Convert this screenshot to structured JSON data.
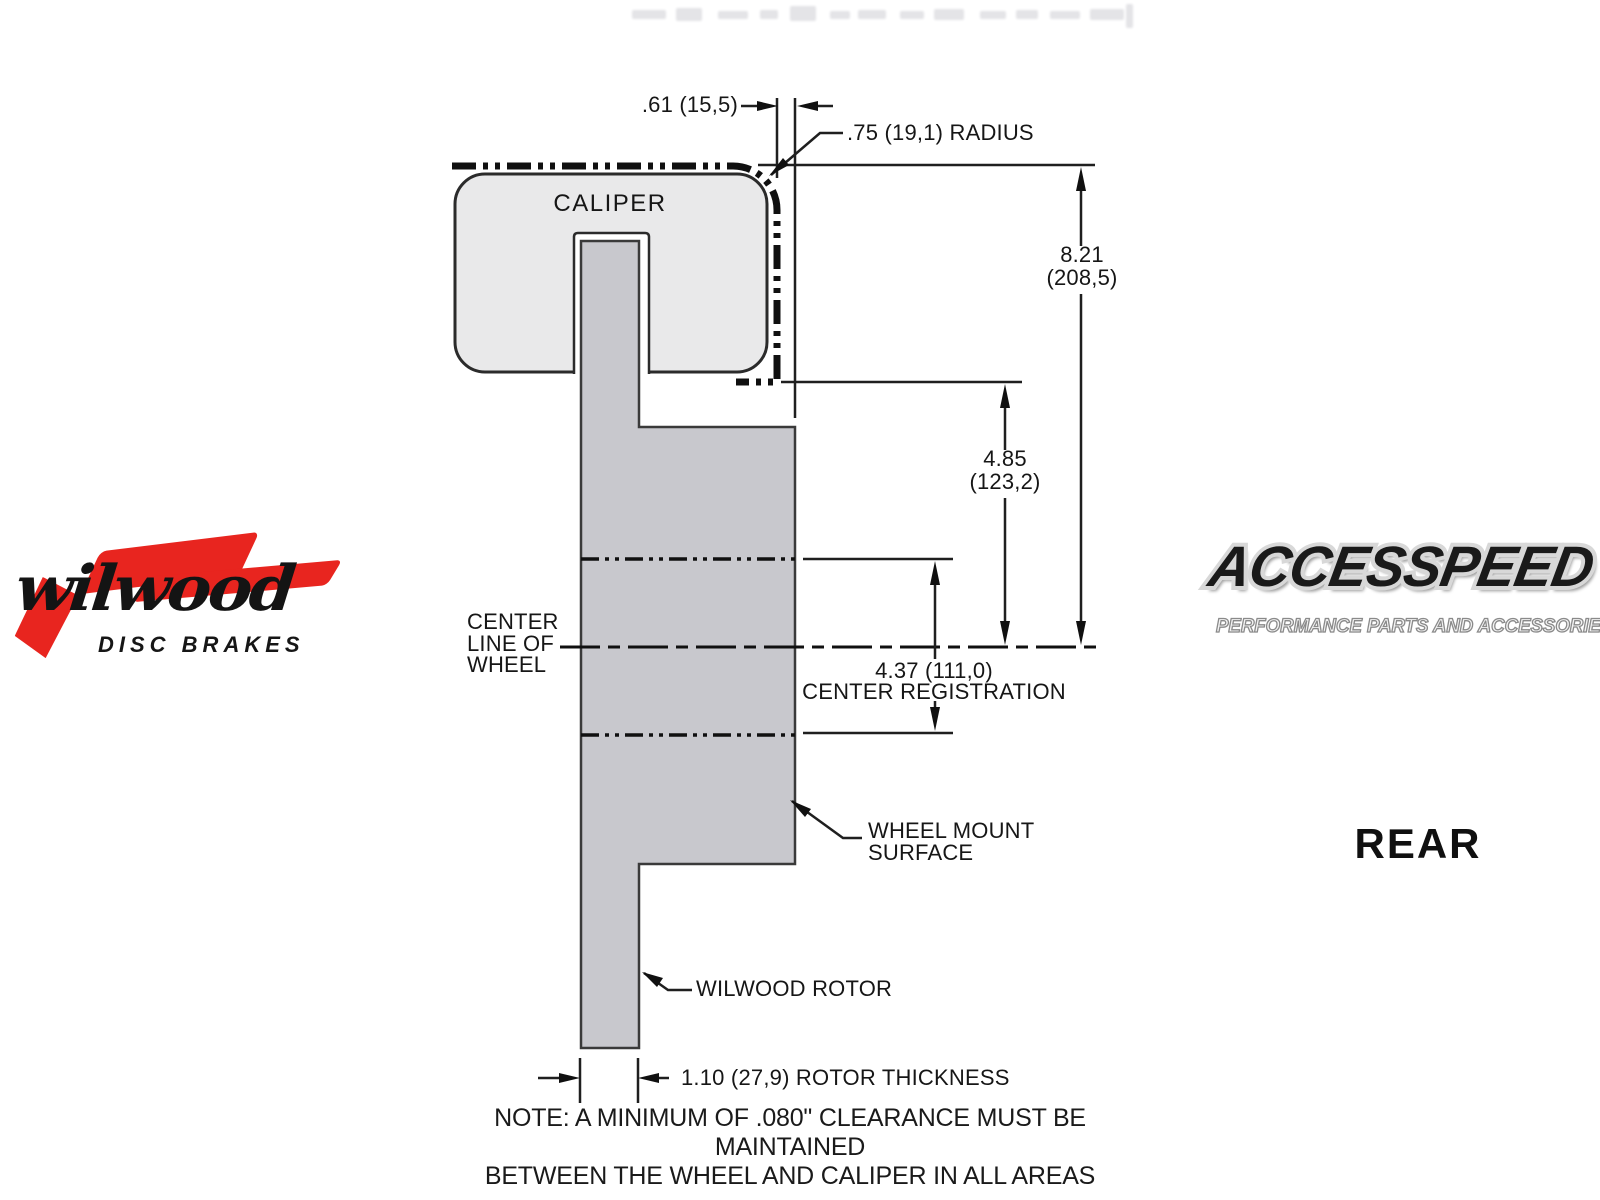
{
  "branding": {
    "wilwood": {
      "name": "wilwood",
      "tagline": "DISC BRAKES"
    },
    "accesspeed": {
      "name": "ACCESSPEED",
      "tagline": "PERFORMANCE PARTS AND ACCESSORIES"
    },
    "view_label": "REAR"
  },
  "diagram": {
    "caliper_label": "CALIPER",
    "dimensions": {
      "caliper_offset": ".61 (15,5)",
      "radius": ".75 (19,1) RADIUS",
      "overall_height": {
        "in": "8.21",
        "mm": "(208,5)"
      },
      "mount_height": {
        "in": "4.85",
        "mm": "(123,2)"
      },
      "center_registration": {
        "value": "4.37 (111,0)",
        "label": "CENTER REGISTRATION"
      },
      "rotor_thickness": "1.10 (27,9) ROTOR THICKNESS"
    },
    "labels": {
      "center_line": [
        "CENTER",
        "LINE OF",
        "WHEEL"
      ],
      "wheel_mount": [
        "WHEEL MOUNT",
        "SURFACE"
      ],
      "rotor": "WILWOOD ROTOR"
    },
    "note": [
      "NOTE: A MINIMUM OF .080\" CLEARANCE MUST BE MAINTAINED",
      "BETWEEN THE WHEEL AND CALIPER IN ALL AREAS"
    ],
    "colors": {
      "caliper_fill": "#e9e9ea",
      "rotor_fill": "#c8c8cd",
      "line": "#1f1f1f",
      "logo_red": "#e8251f"
    }
  }
}
